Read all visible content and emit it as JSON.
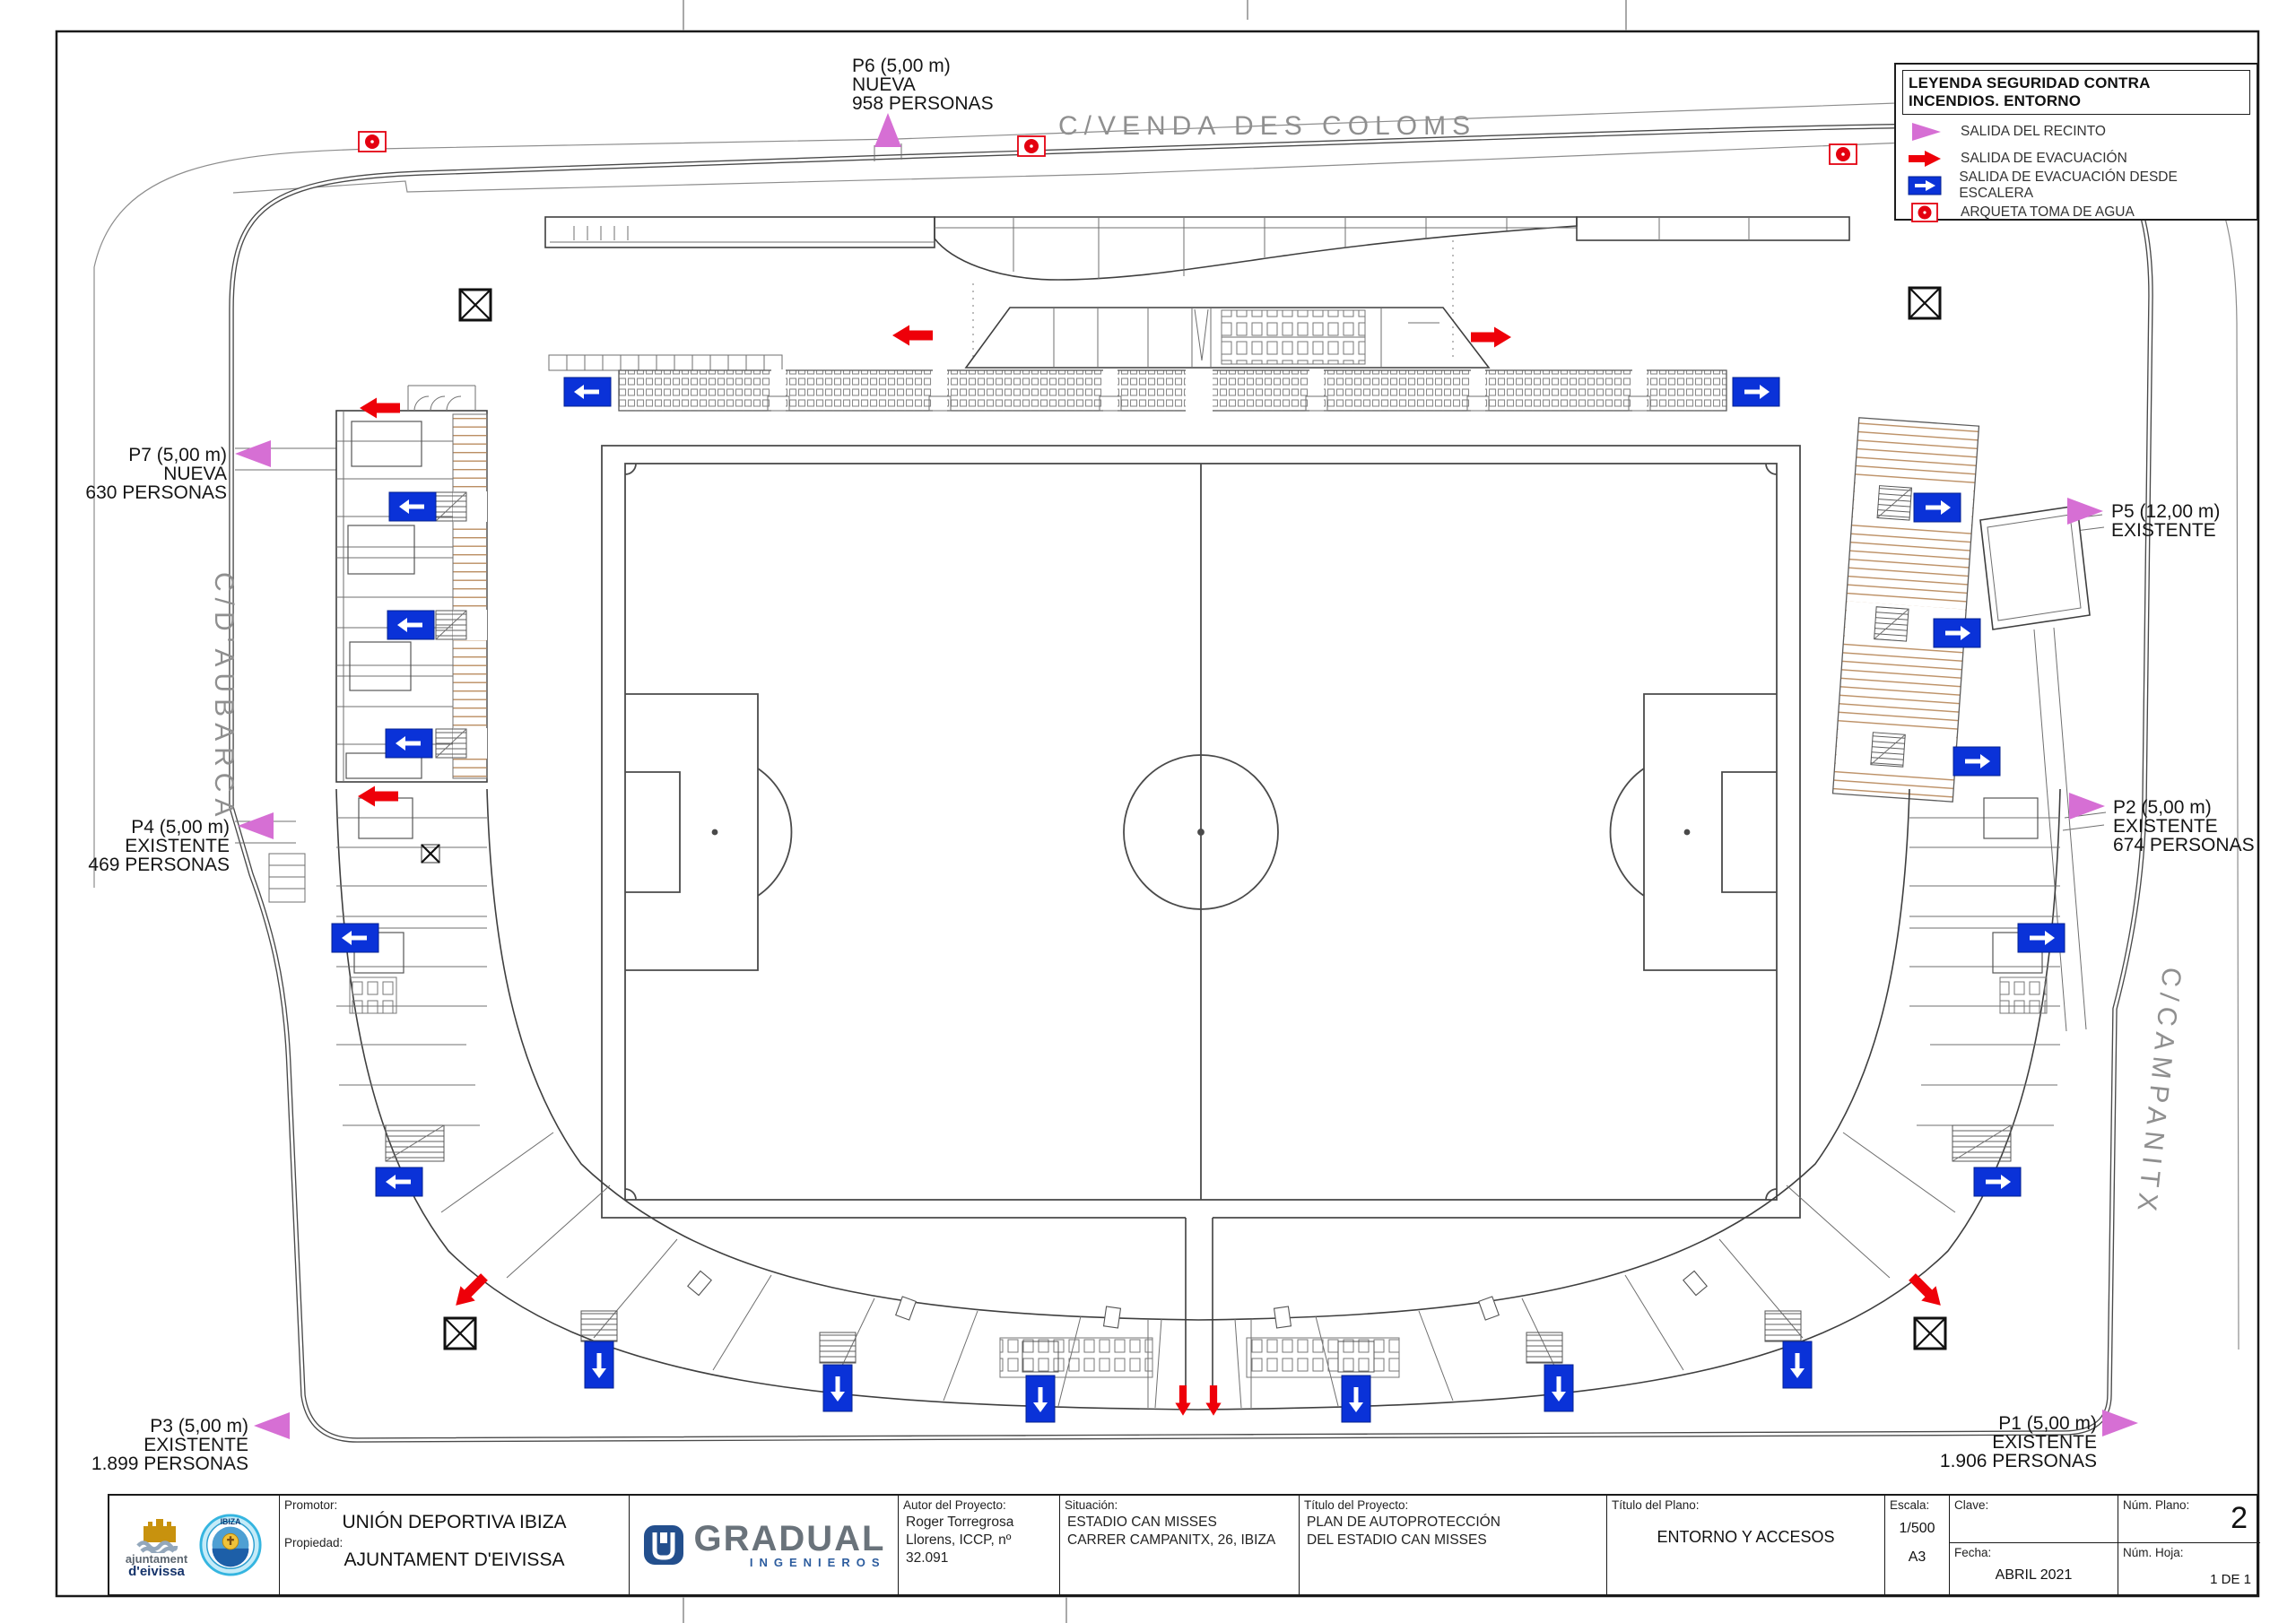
{
  "plan": {
    "streets": {
      "top": "C/VENDA DES COLOMS",
      "left": "C/D'AUBARCA",
      "right": "C/CAMPANITX"
    },
    "exits": {
      "p1": {
        "lines": [
          "P1 (5,00 m)",
          "EXISTENTE",
          "1.906 PERSONAS"
        ]
      },
      "p2": {
        "lines": [
          "P2 (5,00 m)",
          "EXISTENTE",
          "674 PERSONAS"
        ]
      },
      "p3": {
        "lines": [
          "P3 (5,00 m)",
          "EXISTENTE",
          "1.899 PERSONAS"
        ]
      },
      "p4": {
        "lines": [
          "P4 (5,00 m)",
          "EXISTENTE",
          "469 PERSONAS"
        ]
      },
      "p5": {
        "lines": [
          "P5 (12,00 m)",
          "EXISTENTE"
        ]
      },
      "p6": {
        "lines": [
          "P6 (5,00 m)",
          "NUEVA",
          "958 PERSONAS"
        ]
      },
      "p7": {
        "lines": [
          "P7 (5,00 m)",
          "NUEVA",
          "630 PERSONAS"
        ]
      }
    }
  },
  "legend": {
    "title": "LEYENDA SEGURIDAD CONTRA INCENDIOS. ENTORNO",
    "items": [
      {
        "icon": "recinto-arrow",
        "label": "SALIDA DEL RECINTO"
      },
      {
        "icon": "evacuation-arrow",
        "label": "SALIDA DE EVACUACIÓN"
      },
      {
        "icon": "stair-exit-box",
        "label": "SALIDA DE EVACUACIÓN DESDE ESCALERA"
      },
      {
        "icon": "arqueta",
        "label": "ARQUETA TOMA DE AGUA"
      }
    ]
  },
  "colors": {
    "recinto": "#d66fd4",
    "evacuacion": "#ee0009",
    "escalera": "#0a32d8",
    "arqueta": "#e40010"
  },
  "title_block": {
    "logo_ajuntament_line1": "ajuntament",
    "logo_ajuntament_line2": "d'eivissa",
    "logo_ibiza": "IBIZA",
    "promotor_label": "Promotor:",
    "promotor": "UNIÓN DEPORTIVA IBIZA",
    "propiedad_label": "Propiedad:",
    "propiedad": "AJUNTAMENT D'EIVISSA",
    "company_name": "GRADUAL",
    "company_tagline": "INGENIEROS",
    "autor_label": "Autor del Proyecto:",
    "autor_line1": "Roger Torregrosa",
    "autor_line2": "Llorens, ICCP, nº 32.091",
    "situacion_label": "Situación:",
    "situacion_line1": "ESTADIO CAN MISSES",
    "situacion_line2": "CARRER CAMPANITX, 26, IBIZA",
    "proyecto_label": "Título del Proyecto:",
    "proyecto_line1": "PLAN DE AUTOPROTECCIÓN",
    "proyecto_line2": "DEL ESTADIO CAN MISSES",
    "plano_label": "Título del Plano:",
    "plano": "ENTORNO Y ACCESOS",
    "escala_label": "Escala:",
    "escala": "1/500",
    "formato": "A3",
    "clave_label": "Clave:",
    "fecha_label": "Fecha:",
    "fecha": "ABRIL 2021",
    "num_plano_label": "Núm. Plano:",
    "num_plano": "2",
    "num_hoja_label": "Núm. Hoja:",
    "num_hoja": "1 DE 1"
  }
}
